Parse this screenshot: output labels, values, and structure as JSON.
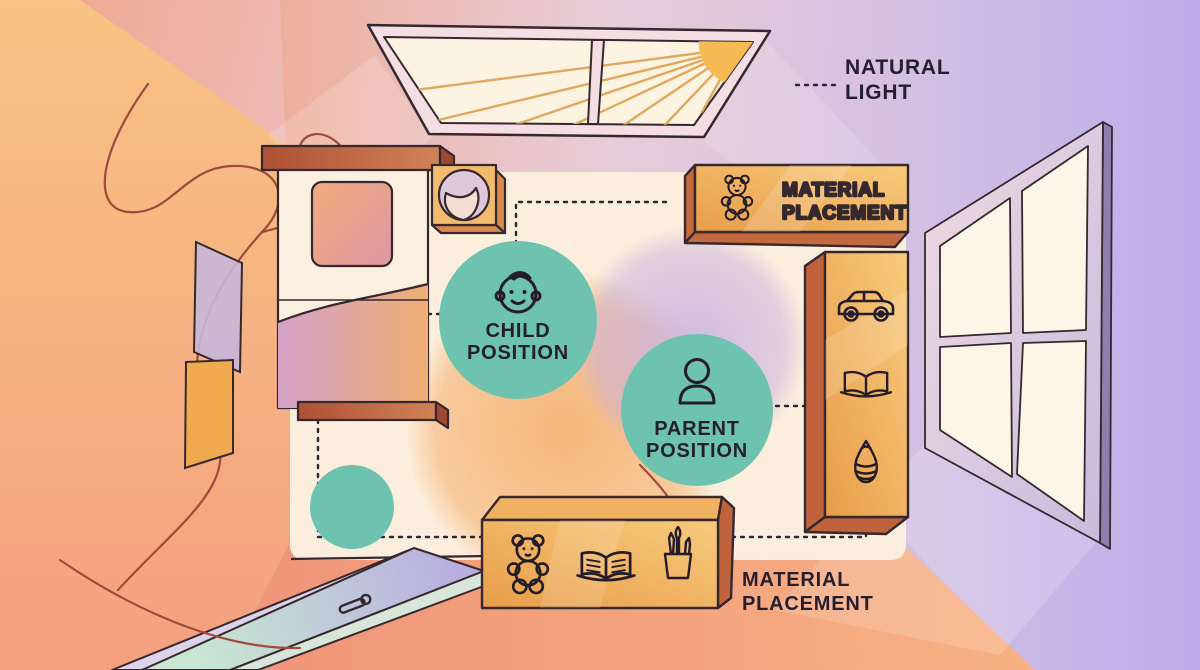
{
  "scene": {
    "type": "room-layout-diagram",
    "description": "Top-down illustrated child's room showing positions and material placement"
  },
  "labels": {
    "natural_light": {
      "line1": "NATURAL",
      "line2": "LIGHT"
    },
    "child_position": {
      "line1": "CHILD",
      "line2": "POSITION"
    },
    "parent_position": {
      "line1": "PARENT",
      "line2": "POSITION"
    },
    "material_top": {
      "line1": "MATERIAL",
      "line2": "PLACEMENT"
    },
    "material_bottom": {
      "line1": "MATERIAL",
      "line2": "PLACEMENT"
    }
  },
  "icons": [
    "sun-icon",
    "teddy-bear-icon",
    "toy-car-icon",
    "open-book-icon",
    "spinning-top-icon",
    "pencil-cup-icon",
    "child-face-icon",
    "parent-icon",
    "door-handle-icon",
    "rolled-mat-icon"
  ],
  "colors": {
    "teal": "#6EC3B0",
    "box_orange": "#F2B35C",
    "box_orange_dark": "#C5693F",
    "label_text": "#241E2E",
    "mat_cream": "#FCEEDC",
    "wall_left_orange": "#F7BB80",
    "wall_salmon": "#EFA28C",
    "wall_lavender": "#C2B2E8",
    "floor_salmon": "#F29A7C",
    "wood_brown": "#B95F3C",
    "sun_yellow": "#F5BB57",
    "line_dark": "#2B2231",
    "door_mint": "#C5E3CE",
    "door_lavender": "#B9AEDE",
    "string_red": "#9E4A3C"
  }
}
